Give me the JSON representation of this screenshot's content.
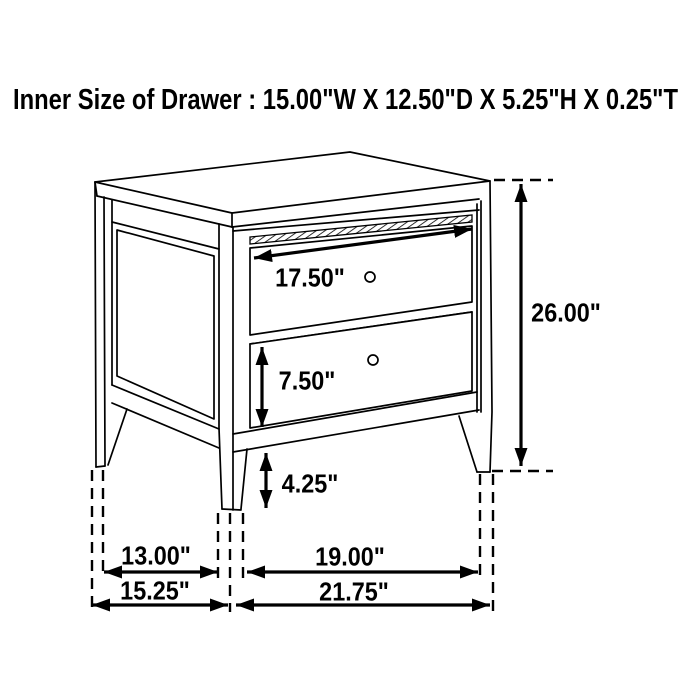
{
  "title": "Inner Size of Drawer : 15.00\"W X 12.50\"D X 5.25\"H X 0.25\"T",
  "dimensions": {
    "top_drawer_width": "17.50\"",
    "bottom_drawer_front_height": "7.50\"",
    "leg_height": "4.25\"",
    "overall_height": "26.00\"",
    "side_leg_spacing": "13.00\"",
    "overall_depth": "15.25\"",
    "front_leg_spacing": "19.00\"",
    "overall_width": "21.75\""
  },
  "style": {
    "line_color": "#000000",
    "background_color": "#ffffff"
  }
}
